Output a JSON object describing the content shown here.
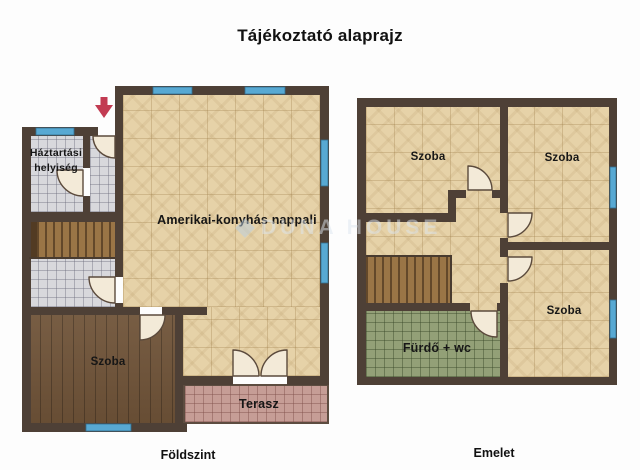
{
  "title": "Tájékoztató alaprajz",
  "watermark": {
    "text": "DUNA HOUSE"
  },
  "colors": {
    "wall": "#4e4036",
    "window": "#58a9d3",
    "floor_tile_beige": "#e6d2a8",
    "floor_tile_gray": "#d8d8dc",
    "floor_wood": "#6f5338",
    "stairs": "#9a7546",
    "terrace_tile": "#c69d96",
    "bathroom_tile": "#93a077",
    "door": "#f3ead8",
    "entrance_arrow": "#c23b52"
  },
  "ground_floor": {
    "label": "Földszint",
    "rooms": [
      {
        "name": "Háztartási helyiség"
      },
      {
        "name": "Amerikai-konyhás nappali"
      },
      {
        "name": "Szoba"
      },
      {
        "name": "Terasz"
      }
    ]
  },
  "upper_floor": {
    "label": "Emelet",
    "rooms": [
      {
        "name": "Szoba"
      },
      {
        "name": "Szoba"
      },
      {
        "name": "Szoba"
      },
      {
        "name": "Fürdő + wc"
      }
    ]
  }
}
